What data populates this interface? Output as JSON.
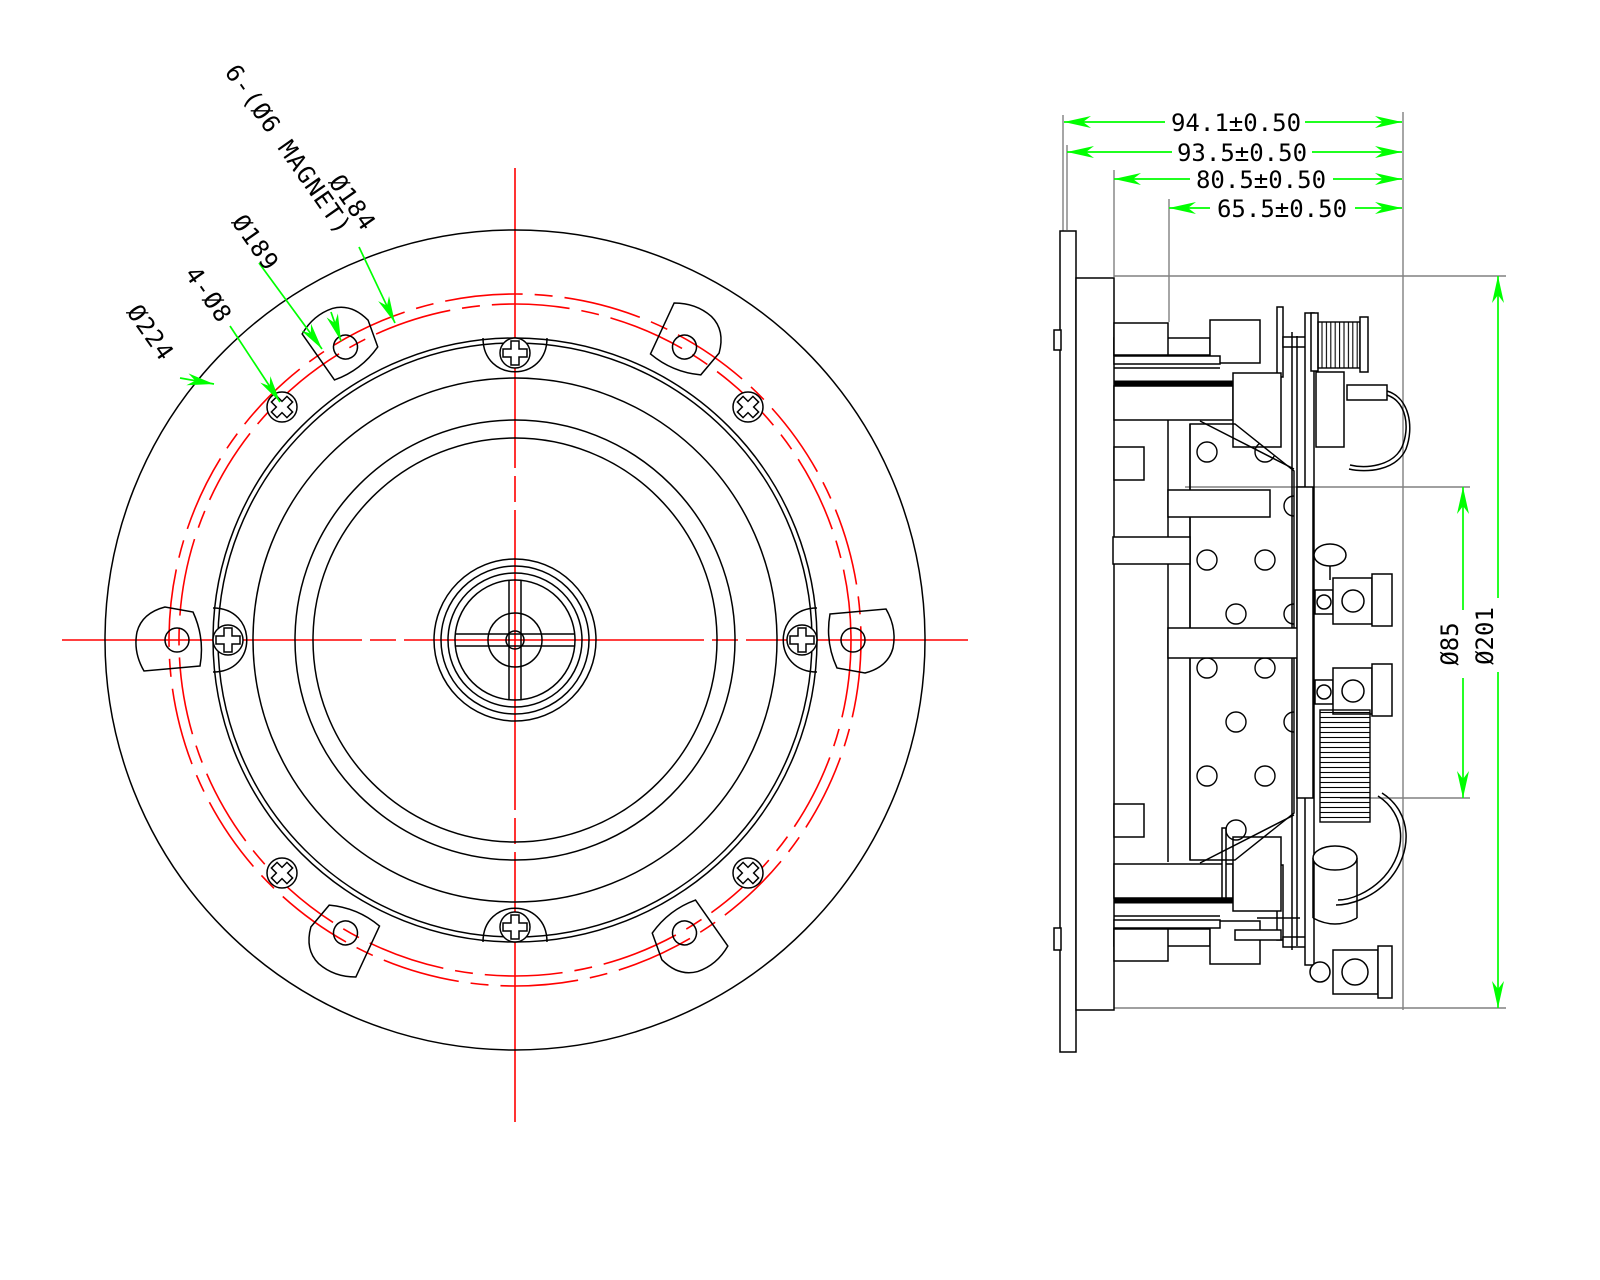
{
  "colors": {
    "line": "#000000",
    "dimension": "#00ff00",
    "centerline": "#ff0000",
    "extension": "#808080",
    "dimtext": "#000000",
    "background": "#ffffff"
  },
  "front_view": {
    "callouts": {
      "flange_od": "Ø224",
      "screw_holes": "4-Ø8",
      "circle_189": "Ø189",
      "magnet_tabs": "6-(Ø6 MAGNET)",
      "circle_184": "Ø184"
    }
  },
  "side_view": {
    "dimensions": {
      "overall_depth": "94.1±0.50",
      "flange_to_back": "93.5±0.50",
      "body_depth": "80.5±0.50",
      "basket_depth": "65.5±0.50",
      "magnet_od": "Ø85",
      "body_od": "Ø201"
    }
  }
}
